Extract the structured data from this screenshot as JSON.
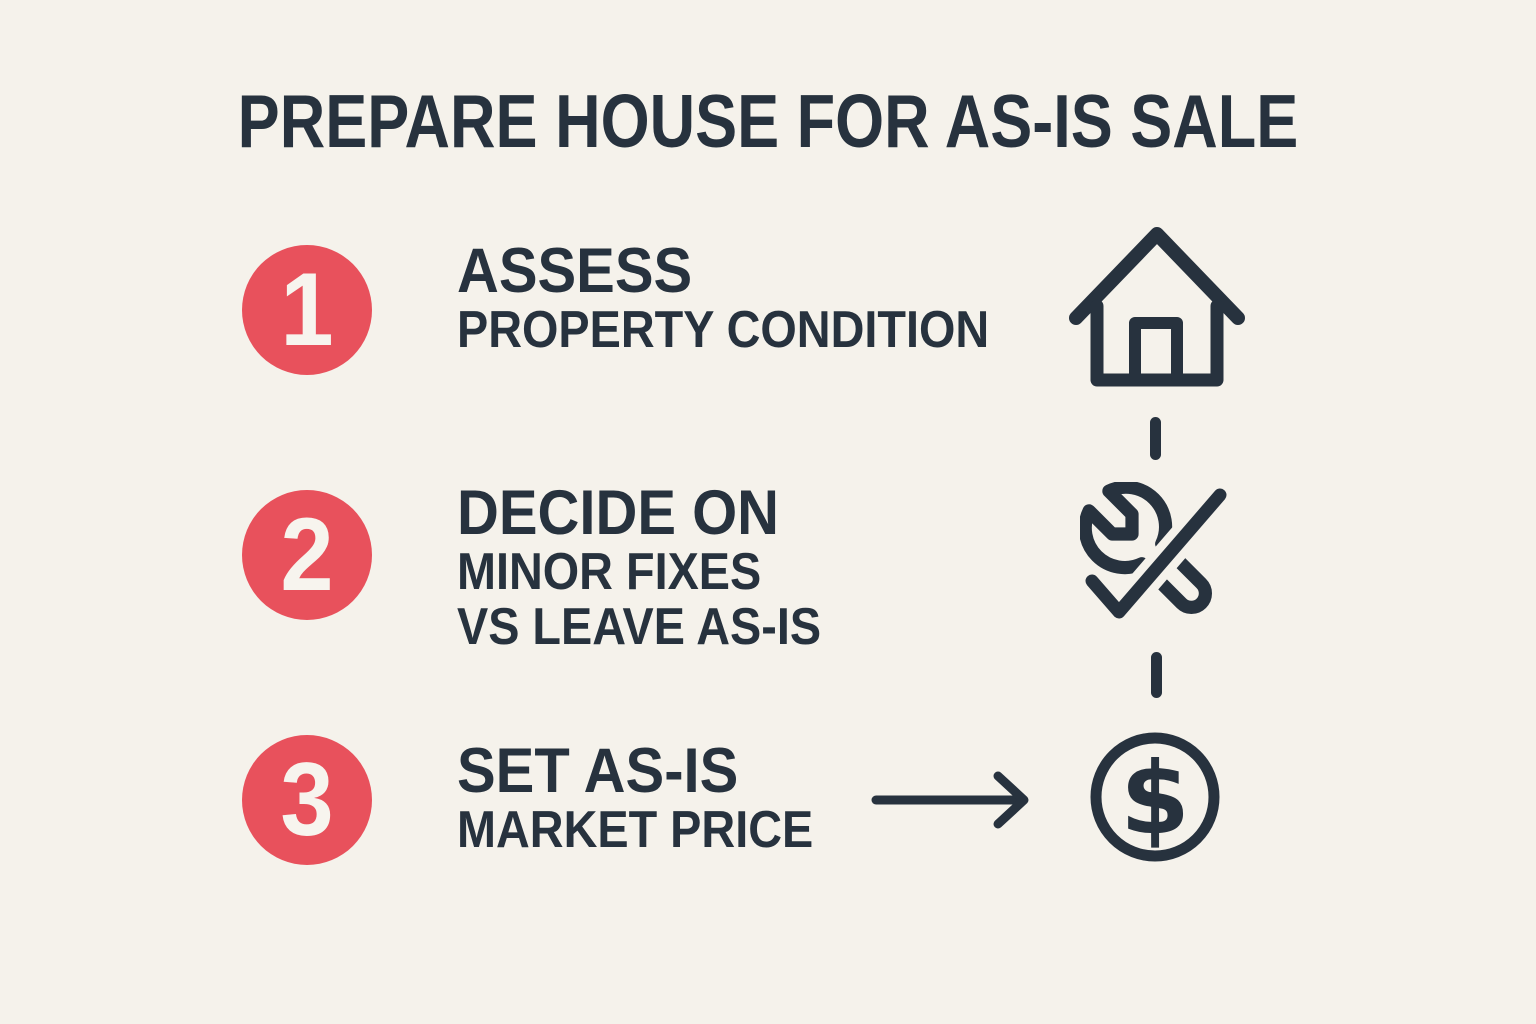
{
  "title": "PREPARE HOUSE FOR AS-IS SALE",
  "colors": {
    "background": "#F5F2EB",
    "ink": "#27323E",
    "accent_red": "#E8515C",
    "badge_number_text": "#F7F4EE"
  },
  "steps": [
    {
      "number": "1",
      "heading": "ASSESS",
      "lines": [
        "PROPERTY CONDITION"
      ],
      "icon": "house-icon"
    },
    {
      "number": "2",
      "heading": "DECIDE ON",
      "lines": [
        "MINOR FIXES",
        "VS LEAVE AS-IS"
      ],
      "icon": "tools-icon"
    },
    {
      "number": "3",
      "heading": "SET AS-IS",
      "lines": [
        "MARKET PRICE"
      ],
      "icon": "dollar-circle-icon"
    }
  ],
  "icons": {
    "flow_column": [
      "house-icon",
      "dashed-connector",
      "tools-icon",
      "dashed-connector",
      "dollar-circle-icon"
    ],
    "arrow": "right-arrow-icon",
    "dollar_symbol": "$"
  }
}
